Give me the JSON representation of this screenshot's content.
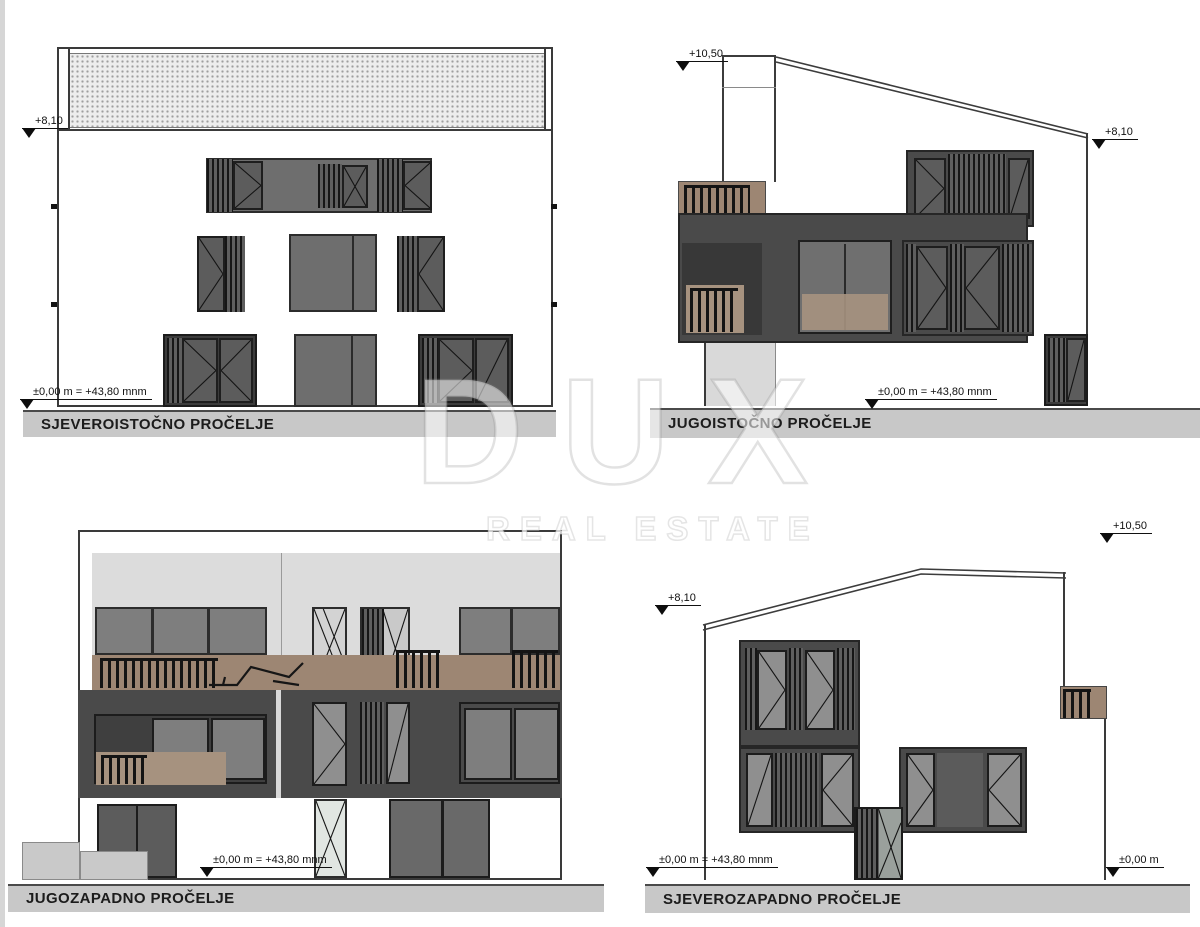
{
  "watermark": {
    "brand": "DUX",
    "tagline": "REAL ESTATE"
  },
  "panels": {
    "northeast": {
      "title": "SJEVEROISTOČNO PROČELJE",
      "markers": {
        "eave": "+8,10",
        "ground": "±0,00 m = +43,80 mnm"
      }
    },
    "southeast": {
      "title": "JUGOISTOČNO PROČELJE",
      "markers": {
        "ridge": "+10,50",
        "eave": "+8,10",
        "ground": "±0,00 m = +43,80 mnm"
      }
    },
    "southwest": {
      "title": "JUGOZAPADNO PROČELJE",
      "markers": {
        "ground": "±0,00 m = +43,80 mnm"
      }
    },
    "northwest": {
      "title": "SJEVEROZAPADNO PROČELJE",
      "markers": {
        "ridge": "+10,50",
        "eave": "+8,10",
        "ground_left": "±0,00 m = +43,80 mnm",
        "ground_right": "±0,00 m"
      }
    }
  },
  "colors": {
    "facade_dark": "#4a4a4a",
    "balcony_brown": "#9d8673",
    "upper_floor_gray": "#dcdcdc",
    "title_bar_gray": "#c8c8c8",
    "drawing_line": "#3a3a3a"
  }
}
